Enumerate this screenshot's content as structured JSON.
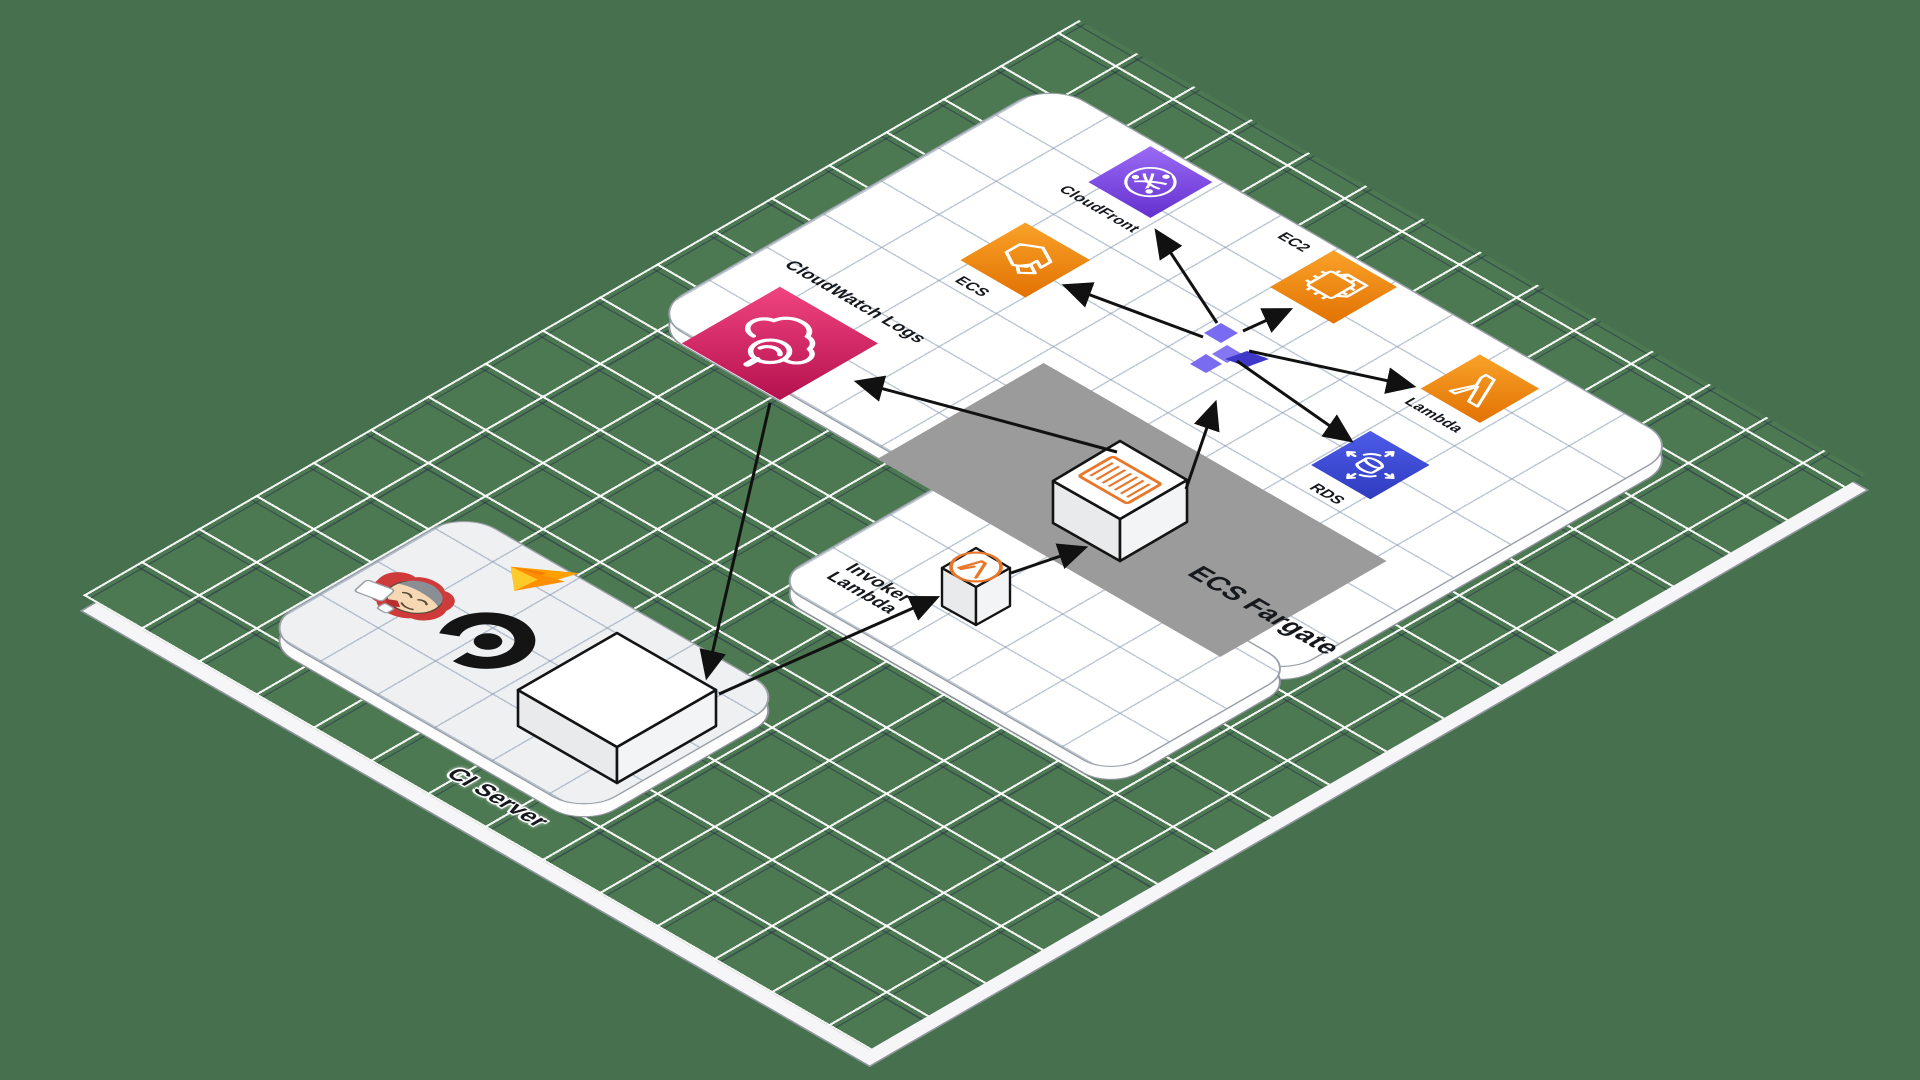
{
  "diagram_title": "CI/CD deployment architecture on AWS (isometric diagram)",
  "platforms": {
    "ci_server_label": "CI Server",
    "fargate_label": "ECS Fargate"
  },
  "nodes": {
    "cloudwatch": {
      "label": "CloudWatch Logs",
      "color": "#d6246b"
    },
    "cloudfront": {
      "label": "CloudFront",
      "color": "#7b4be0"
    },
    "ecs": {
      "label": "ECS",
      "color": "#ef8604"
    },
    "ec2": {
      "label": "EC2",
      "color": "#ef8604"
    },
    "lambda": {
      "label": "Lambda",
      "color": "#ef8604"
    },
    "rds": {
      "label": "RDS",
      "color": "#3d4cd4"
    },
    "invoker": {
      "label_line1": "Invoker",
      "label_line2": "Lambda"
    }
  },
  "logos": [
    "jenkins-mascot",
    "flame-logo",
    "b-logo"
  ],
  "edges": [
    {
      "from": "cloudwatch-logs",
      "to": "ci-server-box"
    },
    {
      "from": "fargate-container",
      "to": "cloudwatch-logs"
    },
    {
      "from": "ci-server-box",
      "to": "invoker-lambda"
    },
    {
      "from": "invoker-lambda",
      "to": "fargate-container"
    },
    {
      "from": "fargate-container",
      "to": "deploy-hub"
    },
    {
      "from": "deploy-hub",
      "to": "ecs"
    },
    {
      "from": "deploy-hub",
      "to": "cloudfront"
    },
    {
      "from": "deploy-hub",
      "to": "ec2"
    },
    {
      "from": "deploy-hub",
      "to": "lambda"
    },
    {
      "from": "deploy-hub",
      "to": "rds"
    }
  ],
  "colors": {
    "background": "#47714E",
    "ground_grid_light": "#ffffff",
    "ground_grid_dark": "#28324a",
    "platform": "#ffffff",
    "shadow_band": "#9b9b9b",
    "arrow": "#111111",
    "hub_purple_light": "#7a6cf0",
    "hub_purple_dark": "#4038c8"
  }
}
